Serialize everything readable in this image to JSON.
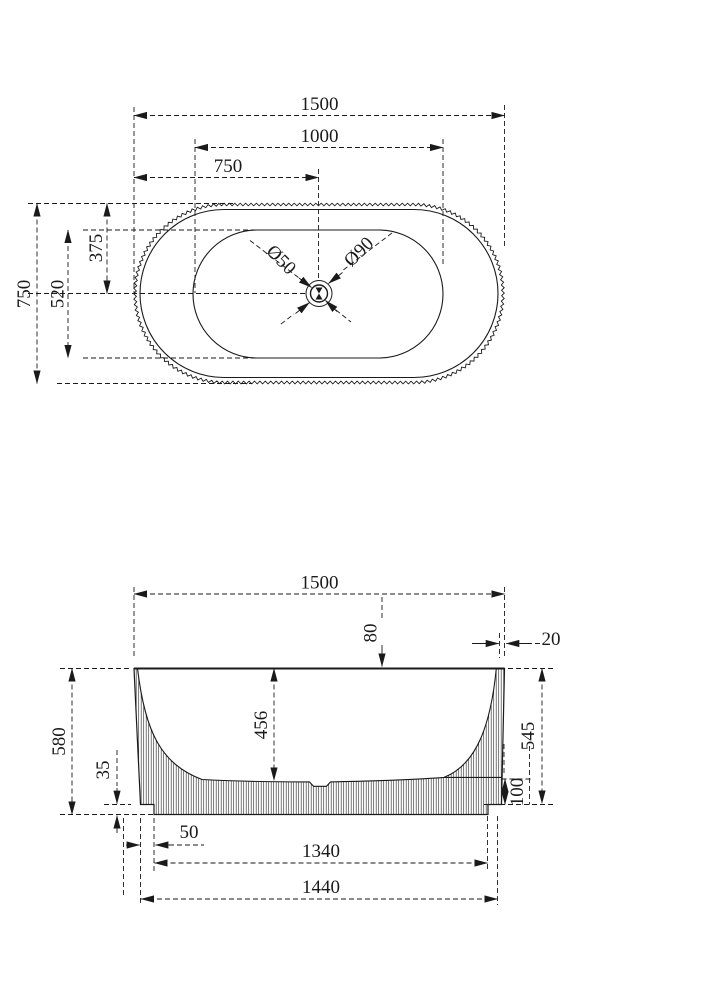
{
  "title": "bathtub-technical-drawing",
  "colors": {
    "ink": "#1a1a1a",
    "highlight": "#2f5fc8"
  },
  "top_view": {
    "dim_overall_width": "1500",
    "dim_inner_width": "1000",
    "dim_center_x": "750",
    "dim_overall_depth": "750",
    "dim_inner_depth": "520",
    "dim_center_y": "375",
    "drain_diameter": "Ø50",
    "flange_diameter": "Ø90"
  },
  "side_view": {
    "dim_overall_width": "1500",
    "dim_rim_ledge": "80",
    "dim_wall_thickness": "20",
    "dim_overall_height": "580",
    "dim_inner_depth": "456",
    "dim_side_height": "545",
    "dim_base_step": "35",
    "dim_base_height": "100",
    "dim_base_offset": "50",
    "dim_base_width": "1340",
    "dim_bottom_width": "1440"
  }
}
